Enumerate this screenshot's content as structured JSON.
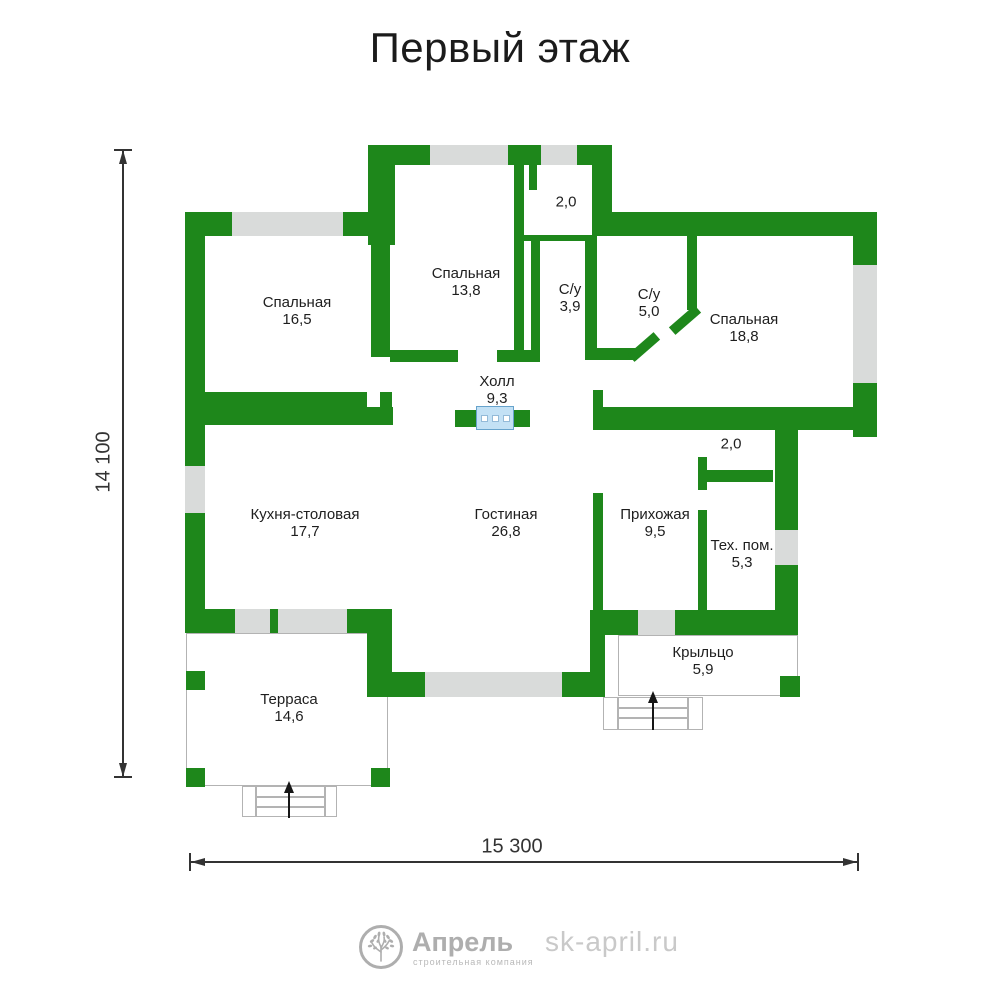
{
  "title": "Первый этаж",
  "rooms": [
    {
      "name": "Спальная",
      "area": "16,5"
    },
    {
      "name": "Спальная",
      "area": "13,8"
    },
    {
      "name": "С/у",
      "area": "3,9"
    },
    {
      "name": "С/у",
      "area": "5,0"
    },
    {
      "name": "Спальная",
      "area": "18,8"
    },
    {
      "name": "Холл",
      "area": "9,3"
    },
    {
      "name": "Кухня-столовая",
      "area": "17,7"
    },
    {
      "name": "Гостиная",
      "area": "26,8"
    },
    {
      "name": "Прихожая",
      "area": "9,5"
    },
    {
      "name": "Тех. пом.",
      "area": "5,3"
    },
    {
      "name": "Крыльцо",
      "area": "5,9"
    },
    {
      "name": "Терраса",
      "area": "14,6"
    }
  ],
  "annotations": [
    {
      "area": "2,0"
    },
    {
      "area": "2,0"
    }
  ],
  "dimensions": {
    "height": "14 100",
    "width": "15 300"
  },
  "footer": {
    "brand": "Апрель",
    "tagline": "строительная компания",
    "website": "sk-april.ru"
  },
  "colors": {
    "wall": "#1e871b",
    "window": "#d9dbda",
    "vent_fill": "#c3e1f5",
    "vent_border": "#67a3cc",
    "vent_square_border": "#93bad8",
    "dim": "#333333",
    "text": "#1e1e1e",
    "title": "#1b1b1b",
    "logo": "#aeaeae",
    "tagline": "#b9b9b9",
    "site": "#c9c9c9",
    "outline": "#b3b3b3",
    "arrow": "#161616"
  }
}
